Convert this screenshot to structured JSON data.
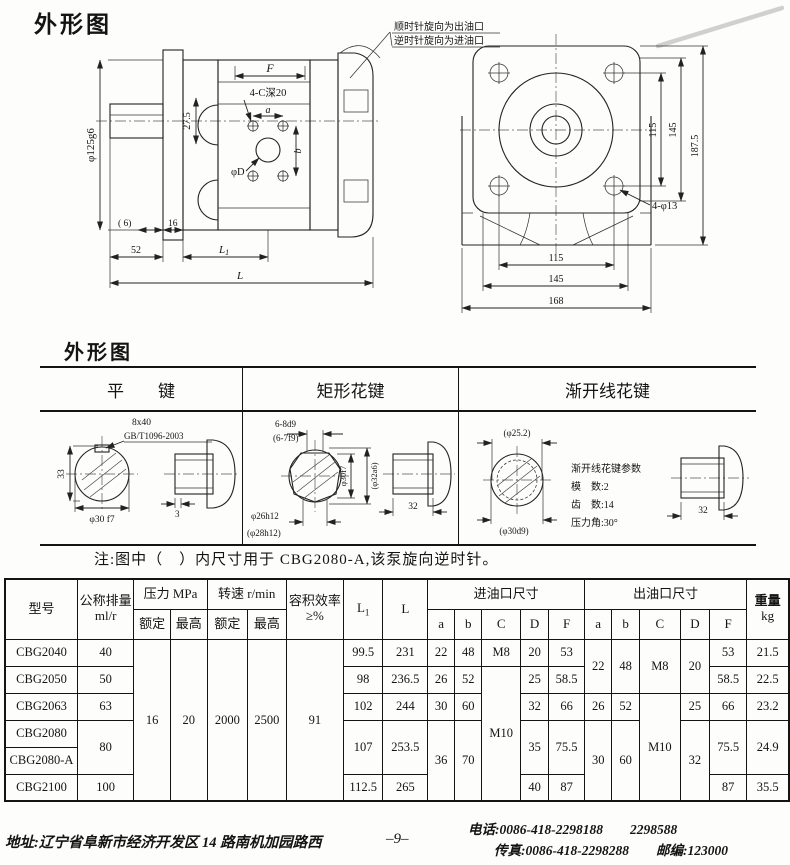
{
  "page": {
    "title_top": "外形图",
    "title_mid": "外形图",
    "note": "注:图中（　）内尺寸用于 CBG2080-A,该泵旋向逆时针。",
    "page_number": "–9–",
    "address": "地址:辽宁省阜新市经济开发区 14 路南机加园路西",
    "phone": "电话:0086-418-2298188　　2298588",
    "fax": "传真:0086-418-2298288",
    "postcode": "邮编:123000"
  },
  "side_view": {
    "callout1": "顺时针旋向为出油口",
    "callout2": "逆时针旋向为进油口",
    "dim_pilot": "φ125g6",
    "dim_275": "27.5",
    "dim_F": "F",
    "dim_tap": "4-C深20",
    "dim_a": "a",
    "dim_b": "b",
    "dim_phiD": "φD",
    "dim_6": "( 6)",
    "dim_16": "16",
    "dim_52": "52",
    "dim_L1_base": "L",
    "dim_L1_sub": "1",
    "dim_L": "L"
  },
  "front_view": {
    "dim_v115": "115",
    "dim_v145": "145",
    "dim_v1875": "187.5",
    "dim_holes": "4-φ13",
    "dim_h115": "115",
    "dim_h145": "145",
    "dim_h168": "168"
  },
  "keys": {
    "headers": [
      "平　　键",
      "矩形花键",
      "渐开线花键"
    ],
    "flat": {
      "c1": "8x40",
      "c2": "GB/T1096-2003",
      "d33": "33",
      "dshaft": "φ30 f7",
      "d3": "3"
    },
    "rect": {
      "s1": "6-8d9",
      "s2": "(6-7f9)",
      "d1": "φ30f7",
      "d2": "(φ32a6)",
      "d3": "φ26h12",
      "d4": "(φ28h12)",
      "len": "32"
    },
    "inv": {
      "d1": "(φ25.2)",
      "d2": "(φ30d9)",
      "t0": "渐开线花键参数",
      "t1": "模　数:2",
      "t2": "齿　数:14",
      "t3": "压力角:30°",
      "len": "32"
    }
  },
  "spec": {
    "h": {
      "model": "型号",
      "disp1": "公称排量",
      "disp2": "ml/r",
      "pressure": "压力 MPa",
      "speed": "转速 r/min",
      "rated": "额定",
      "max": "最高",
      "eff1": "容积效率",
      "eff2": "≥%",
      "L1b": "L",
      "L1s": "1",
      "L": "L",
      "inlet": "进油口尺寸",
      "outlet": "出油口尺寸",
      "w1": "重量",
      "w2": "kg",
      "a": "a",
      "b": "b",
      "C": "C",
      "D": "D",
      "F": "F"
    },
    "shared": {
      "p_rated": "16",
      "p_max": "20",
      "s_rated": "2000",
      "s_max": "2500",
      "eff": "91"
    },
    "rows": [
      {
        "model": "CBG2040",
        "disp": "40",
        "L1": "99.5",
        "L": "231",
        "ia": "22",
        "ib": "48",
        "iC": "M8",
        "iD": "20",
        "iF": "53",
        "oa": "22",
        "ob": "48",
        "oC": "M8",
        "oD": "20",
        "oF": "53",
        "wt": "21.5"
      },
      {
        "model": "CBG2050",
        "disp": "50",
        "L1": "98",
        "L": "236.5",
        "ia": "26",
        "ib": "52",
        "iC": "M10",
        "iD": "25",
        "iF": "58.5",
        "oF": "58.5",
        "wt": "22.5"
      },
      {
        "model": "CBG2063",
        "disp": "63",
        "L1": "102",
        "L": "244",
        "ia": "30",
        "ib": "60",
        "iD": "32",
        "iF": "66",
        "oa": "26",
        "ob": "52",
        "oC": "M10",
        "oD": "25",
        "oF": "66",
        "wt": "23.2"
      },
      {
        "model": "CBG2080",
        "disp": "80",
        "L1": "107",
        "L": "253.5",
        "ia": "36",
        "ib": "70",
        "iD": "35",
        "iF": "75.5",
        "oa": "30",
        "ob": "60",
        "oD": "32",
        "oF": "75.5",
        "wt": "24.9"
      },
      {
        "model": "CBG2080-A"
      },
      {
        "model": "CBG2100",
        "disp": "100",
        "L1": "112.5",
        "L": "265",
        "iD": "40",
        "iF": "87",
        "oF": "87",
        "wt": "35.5"
      }
    ]
  }
}
